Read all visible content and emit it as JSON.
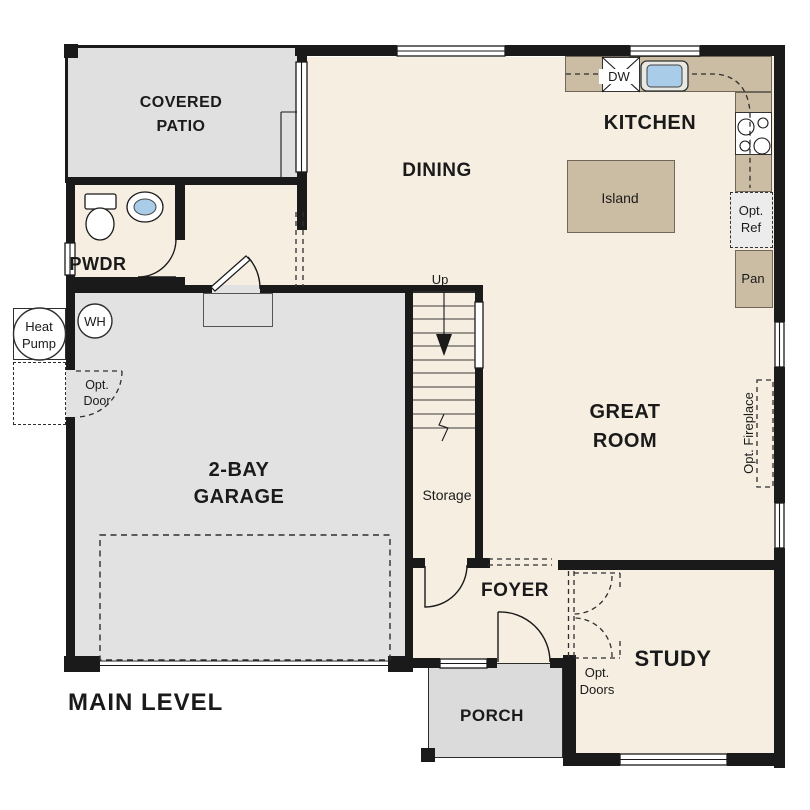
{
  "plan_title": "MAIN LEVEL",
  "rooms": {
    "covered_patio": {
      "line1": "COVERED",
      "line2": "PATIO"
    },
    "dining": {
      "label": "DINING"
    },
    "kitchen": {
      "label": "KITCHEN"
    },
    "pwdr": {
      "label": "PWDR"
    },
    "garage": {
      "line1": "2-BAY",
      "line2": "GARAGE"
    },
    "great_room": {
      "line1": "GREAT",
      "line2": "ROOM"
    },
    "foyer": {
      "label": "FOYER"
    },
    "study": {
      "label": "STUDY"
    },
    "porch": {
      "label": "PORCH"
    },
    "storage": {
      "label": "Storage"
    }
  },
  "annotations": {
    "up": "Up",
    "island": "Island",
    "dishwasher": "DW",
    "opt_ref": {
      "line1": "Opt.",
      "line2": "Ref"
    },
    "pantry": "Pan",
    "water_heater": "WH",
    "heat_pump": {
      "line1": "Heat",
      "line2": "Pump"
    },
    "opt_door": {
      "line1": "Opt.",
      "line2": "Door"
    },
    "opt_doors": {
      "line1": "Opt.",
      "line2": "Doors"
    },
    "opt_fireplace": "Opt. Fireplace"
  },
  "colors": {
    "wall": "#1a1a1a",
    "line": "#1a1a1a",
    "floor": "#f6eee1",
    "patio": "#e0e0e0",
    "garage": "#e2e2e2",
    "porch": "#dbdbdb",
    "counter": "#cbbda3",
    "counter_border": "#6f675a",
    "sink": "#a9cde9",
    "appliance": "#ececec"
  }
}
